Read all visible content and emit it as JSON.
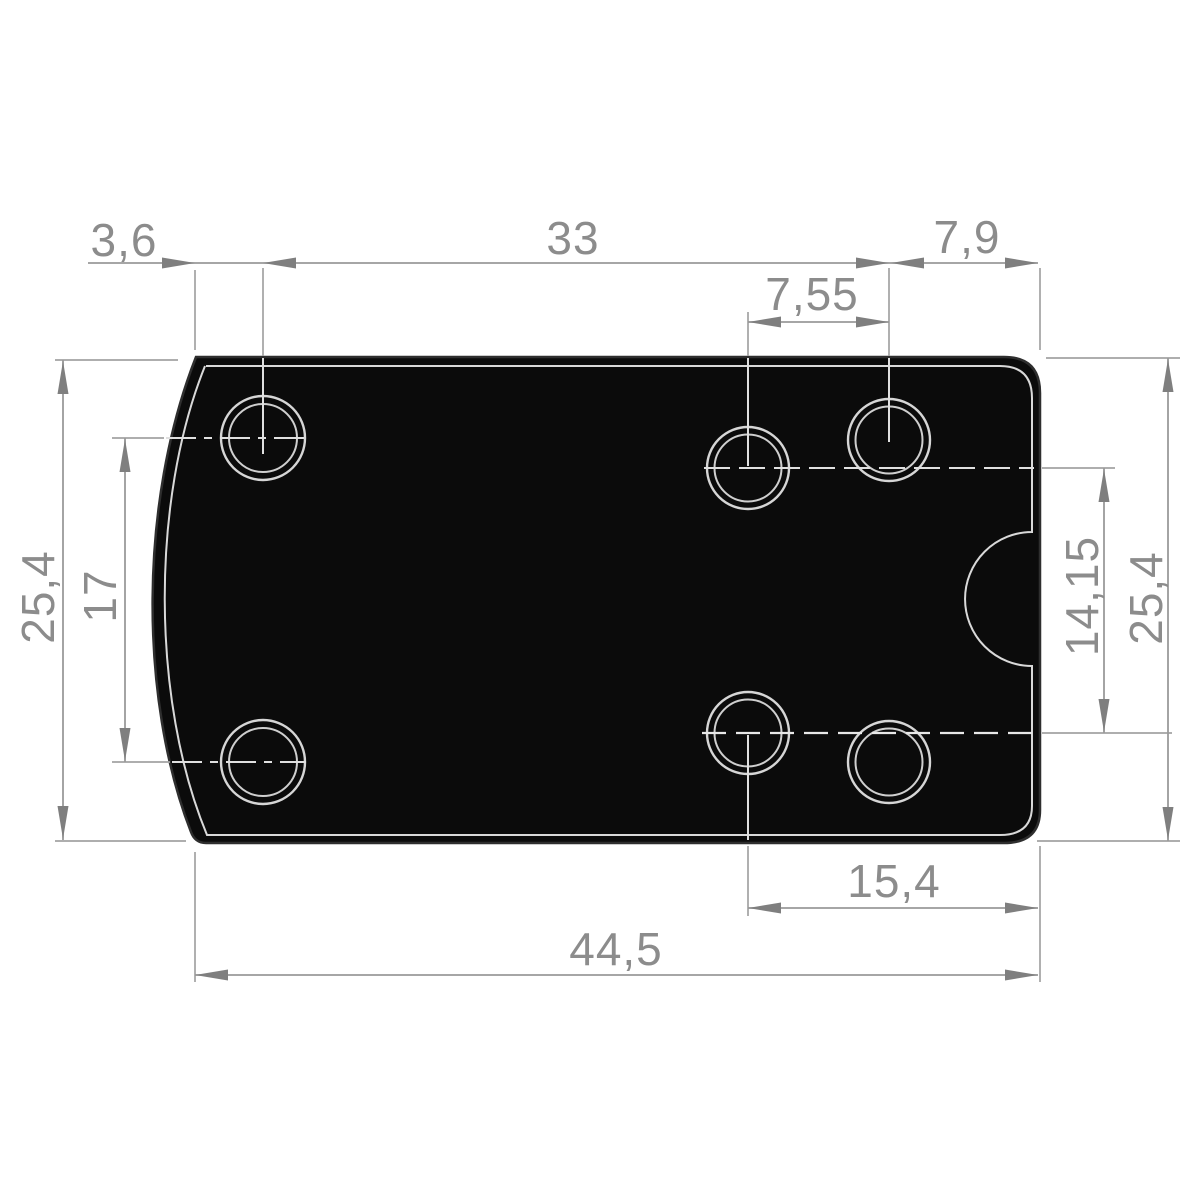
{
  "drawing": {
    "kind": "technical-dimension-drawing",
    "subject": "rectangular mounting plate, top view, six counterbored holes, curved left edge, semicircular notch on right edge",
    "decimal_separator": "comma",
    "dimensions": [
      {
        "id": "left-edge-to-front-hole",
        "value": "3,6"
      },
      {
        "id": "front-to-rear-hole-span",
        "value": "33"
      },
      {
        "id": "rear-hole-to-right-edge",
        "value": "7,9"
      },
      {
        "id": "rear-hole-pair-offset",
        "value": "7,55"
      },
      {
        "id": "overall-height-left",
        "value": "25,4"
      },
      {
        "id": "front-hole-vertical-spacing",
        "value": "17"
      },
      {
        "id": "rear-hole-vertical-spacing",
        "value": "14,15"
      },
      {
        "id": "overall-height-right",
        "value": "25,4"
      },
      {
        "id": "bottom-hole-to-right-edge",
        "value": "15,4"
      },
      {
        "id": "overall-width",
        "value": "44,5"
      }
    ],
    "colors": {
      "background": "#ffffff",
      "plate": "#0b0b0b",
      "dimension_lines": "#9a9a9a",
      "dimension_text": "#8c8c8c",
      "contour_lines": "#d9d9d9"
    }
  }
}
